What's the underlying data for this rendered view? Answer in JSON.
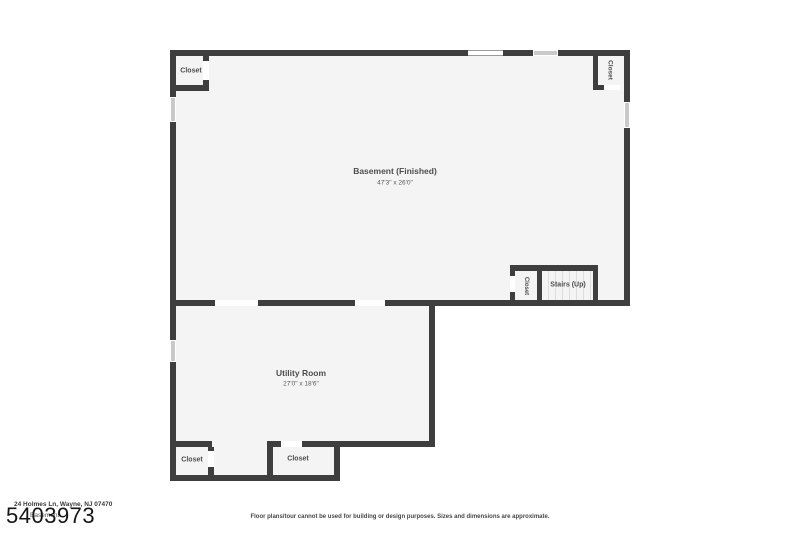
{
  "plan": {
    "basement": {
      "name": "Basement (Finished)",
      "dims": "47'3\" x 26'0\""
    },
    "utility": {
      "name": "Utility Room",
      "dims": "27'0\" x 18'6\""
    },
    "stairs": {
      "label": "Stairs (Up)"
    },
    "closets": {
      "top_left": "Closet",
      "top_right": "Closet",
      "basement_right": "Closet",
      "bottom_left": "Closet",
      "bottom_middle": "Closet"
    },
    "colors": {
      "wall": "#3e3e3e",
      "floor": "#f4f4f4",
      "window": "#c9c9c9",
      "background": "#ffffff"
    }
  },
  "footer": {
    "address": "24 Holmes Ln, Wayne, NJ 07470",
    "floor_name": "Basement",
    "plan_id": "5403973",
    "disclaimer": "Floor plans/tour cannot be used for building or design purposes. Sizes and dimensions are approximate."
  }
}
